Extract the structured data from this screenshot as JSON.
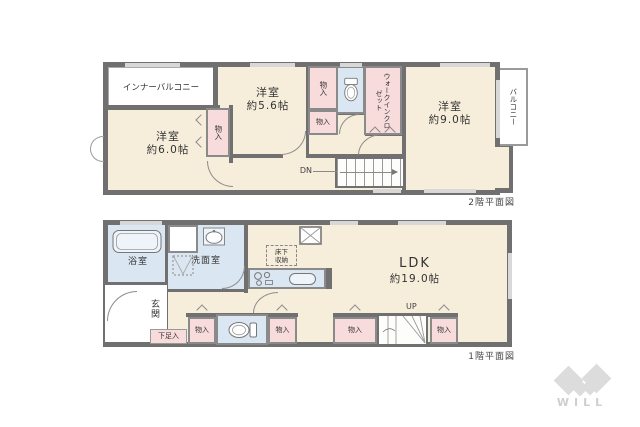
{
  "colors": {
    "wall": "#707070",
    "outline": "#8a8a8a",
    "room": "#f6eddb",
    "closet": "#f8dbdb",
    "wet": "#dae6f1",
    "window": "#d8d8d8",
    "logo": "#dcdcdc"
  },
  "floor2": {
    "caption": "2階平面図",
    "inner_balcony": "インナーバルコニー",
    "balcony": "バルコニー",
    "rooms": {
      "r56": {
        "name": "洋室",
        "size": "約5.6帖"
      },
      "r60": {
        "name": "洋室",
        "size": "約6.0帖"
      },
      "r90": {
        "name": "洋室",
        "size": "約9.0帖"
      }
    },
    "closet_a": "物入",
    "closet_b": "物入",
    "closet_c": "物入",
    "wic": "ウォークインクロゼット",
    "stairs": "DN"
  },
  "floor1": {
    "caption": "1階平面図",
    "bath": "浴室",
    "washroom": "洗面室",
    "entrance": "玄関",
    "shoe_box": "下足入",
    "underfloor_1": "床下",
    "underfloor_2": "収納",
    "ldk": {
      "name": "LDK",
      "size": "約19.0帖"
    },
    "closet1": "物入",
    "closet2": "物入",
    "closet3": "物入",
    "closet4": "物入",
    "stairs": "UP"
  },
  "logo": {
    "text": "WILL"
  }
}
